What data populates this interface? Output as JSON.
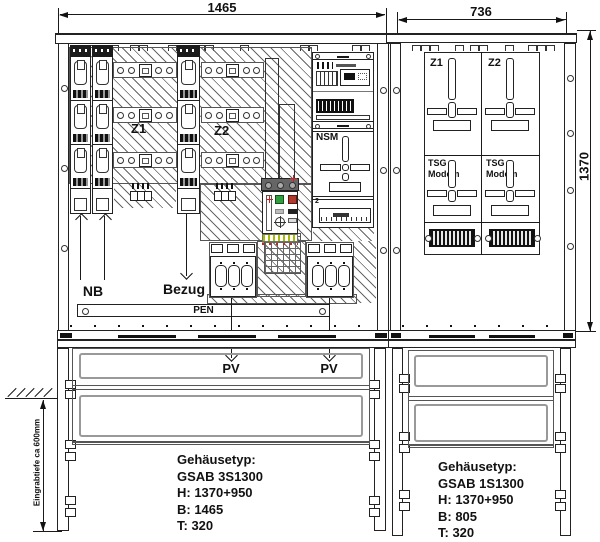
{
  "dims": {
    "left_width": "1465",
    "right_width": "736",
    "right_height": "1370",
    "burial_note": "Eingrabtiefe ca 600mm"
  },
  "left_cab": {
    "z1": "Z1",
    "z2": "Z2",
    "nsm": "NSM",
    "klemmen_index": "2",
    "nb": "NB",
    "bezug": "Bezug",
    "pen": "PEN",
    "pv_left": "PV",
    "pv_right": "PV",
    "spec": {
      "line1": "Gehäusetyp:",
      "line2": "GSAB 3S1300",
      "line3": "H: 1370+950",
      "line4": "B: 1465",
      "line5": "T: 320"
    }
  },
  "right_cab": {
    "z1": "Z1",
    "z2": "Z2",
    "tsg_left": {
      "l1": "TSG",
      "l2": "Modem"
    },
    "tsg_right": {
      "l1": "TSG",
      "l2": "Modem"
    },
    "spec": {
      "line1": "Gehäusetyp:",
      "line2": "GSAB 1S1300",
      "line3": "H: 1370+950",
      "line4": "B: 805",
      "line5": "T: 320"
    }
  }
}
